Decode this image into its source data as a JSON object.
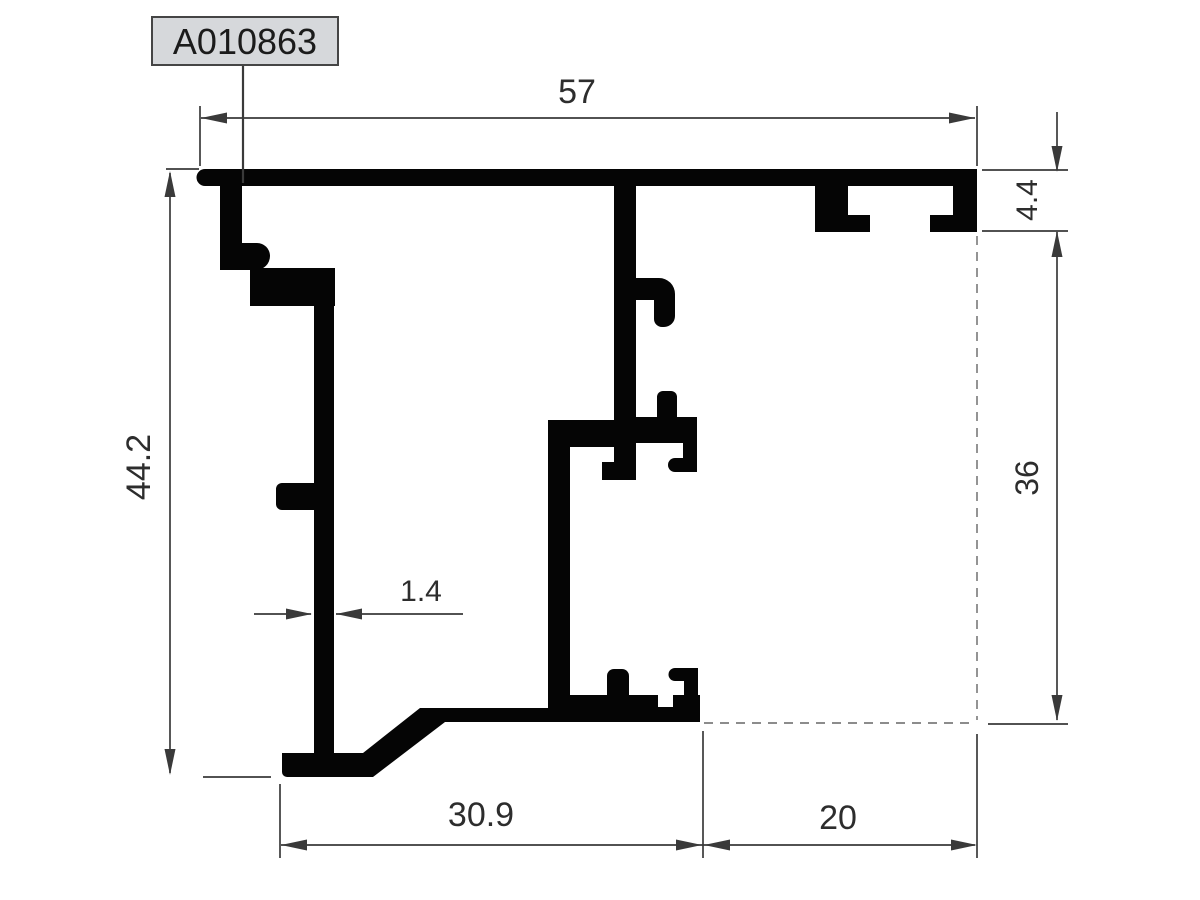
{
  "drawing": {
    "part_label": "A010863",
    "dimensions": {
      "overall_width": "57",
      "lip_height": "4.4",
      "inner_height": "36",
      "overall_height": "44.2",
      "wall_thickness": "1.4",
      "bottom_left_width": "30.9",
      "bottom_right_width": "20"
    },
    "colors": {
      "profile": "#050505",
      "dimension_lines": "#3a3a3a",
      "text": "#2d2d2d",
      "label_box_fill": "#d6d8db",
      "label_box_border": "#454545",
      "background": "#ffffff"
    }
  }
}
